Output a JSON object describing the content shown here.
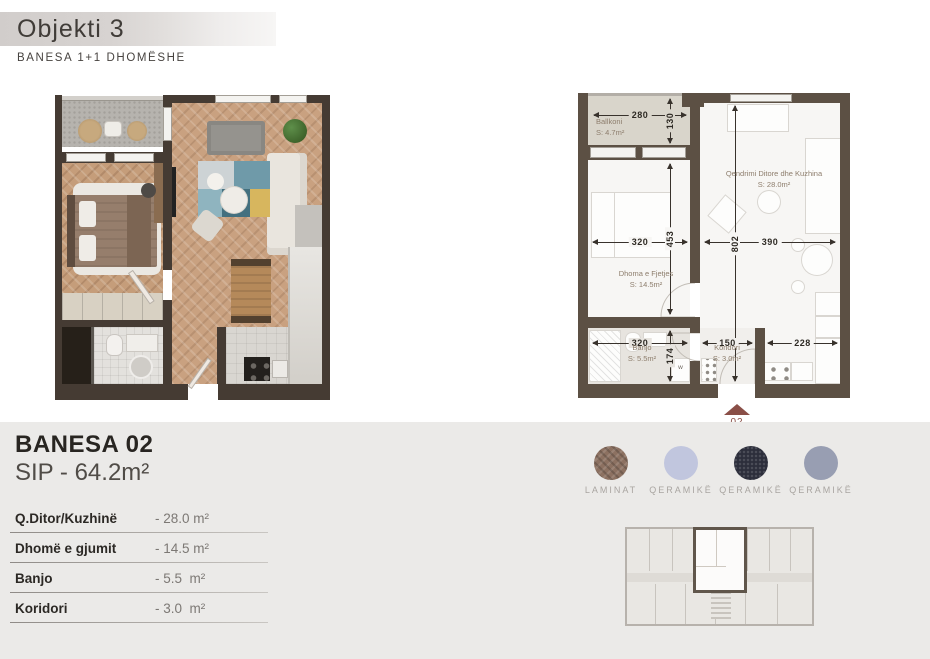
{
  "header": {
    "title": "Objekti 3",
    "subtitle": "BANESA 1+1 DHOMËSHE"
  },
  "unit": {
    "name": "BANESA 02",
    "area": "SIP - 64.2m²"
  },
  "room_table": [
    {
      "label": "Q.Ditor/Kuzhinë",
      "value": "- 28.0 m²"
    },
    {
      "label": "Dhomë e gjumit",
      "value": "- 14.5 m²"
    },
    {
      "label": "Banjo",
      "value": "- 5.5  m²"
    },
    {
      "label": "Koridori",
      "value": "- 3.0  m²"
    }
  ],
  "plan": {
    "rooms": {
      "ballkoni": {
        "name": "Ballkoni",
        "area": "S: 4.7m²"
      },
      "living": {
        "name": "Qendrimi Ditore dhe Kuzhina",
        "area": "S: 28.0m²"
      },
      "bedroom": {
        "name": "Dhoma e Fjetjes",
        "area": "S: 14.5m²"
      },
      "banjo": {
        "name": "Banjo",
        "area": "S: 5.5m²"
      },
      "koridori": {
        "name": "Koridori",
        "area": "S: 3.0m²"
      }
    },
    "dims": {
      "balcony_w": "280",
      "balcony_d": "130",
      "bedroom_w": "320",
      "bedroom_d": "453",
      "living_w": "390",
      "living_d": "802",
      "bath_w": "320",
      "bath_d": "174",
      "koridor_w": "150",
      "kitchen_w": "228"
    },
    "entrance": "02",
    "washer": "w"
  },
  "materials": [
    {
      "label": "LAMINAT",
      "color": "#8c7161"
    },
    {
      "label": "QERAMIKË",
      "color": "#c1c6de"
    },
    {
      "label": "QERAMIKË",
      "color": "#2c2e3b"
    },
    {
      "label": "QERAMIKË",
      "color": "#989eb2"
    }
  ],
  "colors": {
    "wall": "#5c5044",
    "entrance_marker": "#8a4f47",
    "band_bg": "#ebeae8"
  }
}
